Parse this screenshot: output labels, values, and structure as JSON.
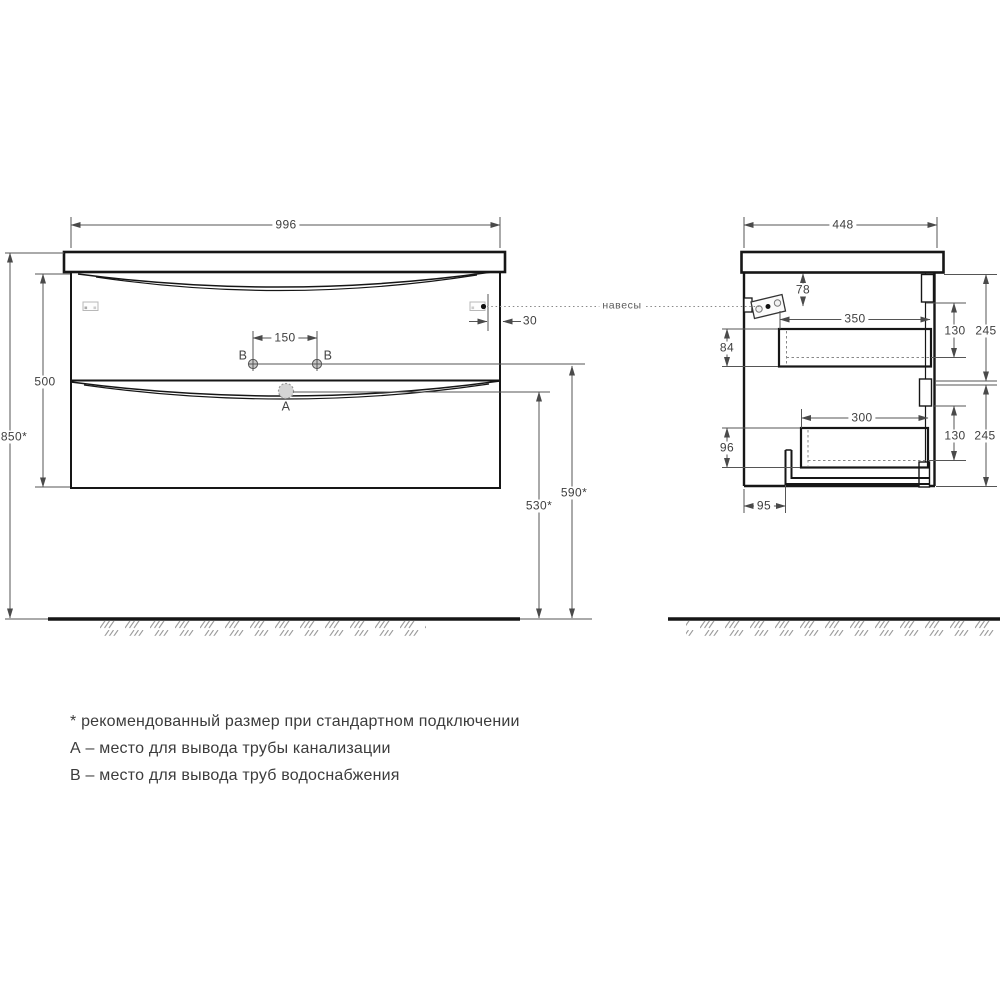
{
  "front_view": {
    "width_label": "996",
    "overall_height_label": "850*",
    "cabinet_height_label": "500",
    "holes_spacing_label": "150",
    "hinge_offset_label": "30",
    "supply_line_height_label": "590*",
    "drain_line_height_label": "530*",
    "hole_left_label": "B",
    "hole_right_label": "B",
    "drain_label": "A"
  },
  "side_view": {
    "depth_label": "448",
    "hinge_drop_label": "78",
    "top_drawer_width_label": "350",
    "top_drawer_depth_label": "84",
    "top_front_gap_label": "130",
    "top_front_height_label": "245",
    "bottom_drawer_width_label": "300",
    "bottom_drawer_depth_label": "96",
    "bottom_front_gap_label": "130",
    "bottom_front_height_label": "245",
    "pipe_offset_label": "95"
  },
  "callouts": {
    "hinges": "навесы"
  },
  "notes": {
    "asterisk": "* рекомендованный размер при стандартном подключении",
    "a": "А – место для вывода трубы канализации",
    "b": "В – место для вывода труб водоснабжения"
  },
  "colors": {
    "structure_line": "#161616",
    "dim_line": "#555555",
    "dim_text": "#3f3f3f",
    "hatch": "#9b9b9b",
    "note_text": "#3c3c3c"
  }
}
